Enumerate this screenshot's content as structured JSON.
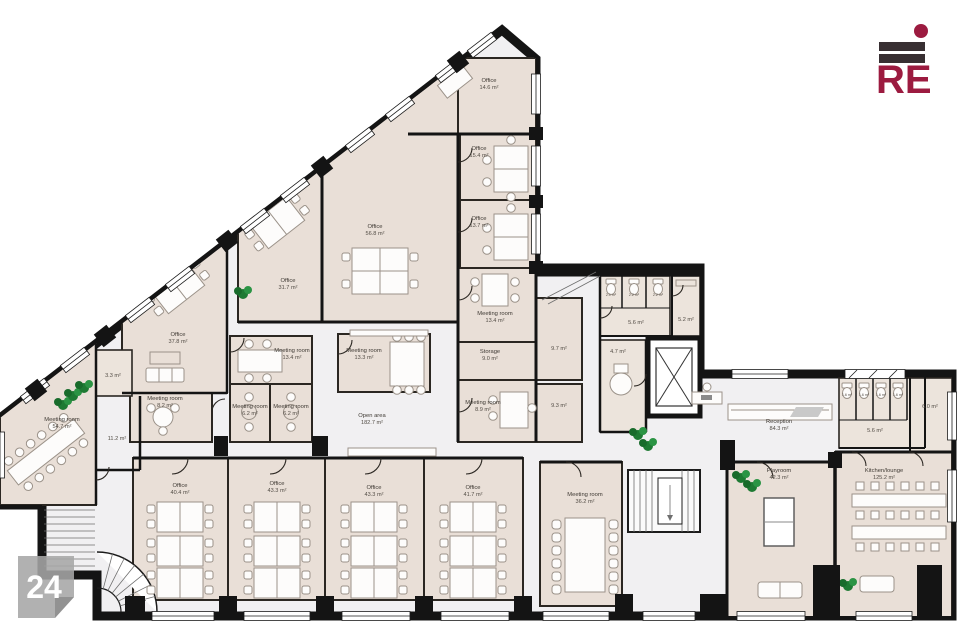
{
  "page_number": "24",
  "logo": {
    "text": "RE",
    "accent_color": "#9c1b40",
    "bar_color": "#382f32"
  },
  "floor_plan": {
    "rooms": [
      {
        "name": "Office",
        "area": "14.6 m²"
      },
      {
        "name": "Office",
        "area": "15.4 m²"
      },
      {
        "name": "Office",
        "area": "13.7 m²"
      },
      {
        "name": "Meeting room",
        "area": "13.4 m²"
      },
      {
        "name": "Storage",
        "area": "9.0 m²"
      },
      {
        "name": "Meeting room",
        "area": "8.9 m²"
      },
      {
        "name": "Office",
        "area": "56.8 m²"
      },
      {
        "name": "Office",
        "area": "31.7 m²"
      },
      {
        "name": "Office",
        "area": "37.8 m²"
      },
      {
        "name": "Meeting room",
        "area": "8.2 m²"
      },
      {
        "name": "Meeting room",
        "area": "13.4 m²"
      },
      {
        "name": "Meeting room",
        "area": "6.2 m²"
      },
      {
        "name": "Meeting room",
        "area": "6.2 m²"
      },
      {
        "name": "Meeting room",
        "area": "13.3 m²"
      },
      {
        "name": "Open area",
        "area": "182.7 m²"
      },
      {
        "name": "Meeting room",
        "area": "54.7 m²"
      },
      {
        "area": "3.3 m²"
      },
      {
        "area": "11.2 m²"
      },
      {
        "area": "9.7 m²"
      },
      {
        "area": "9.3 m²"
      },
      {
        "area": "2.1 m²"
      },
      {
        "area": "2.2 m²"
      },
      {
        "area": "2.2 m²"
      },
      {
        "area": "5.6 m²"
      },
      {
        "area": "5.2 m²"
      },
      {
        "area": "4.7 m²"
      },
      {
        "name": "Reception",
        "area": "84.3 m²"
      },
      {
        "area": "1.6 m²"
      },
      {
        "area": "1.6 m²"
      },
      {
        "area": "1.6 m²"
      },
      {
        "area": "1.6 m²"
      },
      {
        "area": "5.6 m²"
      },
      {
        "area": "6.0 m²"
      },
      {
        "name": "Office",
        "area": "40.4 m²"
      },
      {
        "name": "Office",
        "area": "43.3 m²"
      },
      {
        "name": "Office",
        "area": "43.3 m²"
      },
      {
        "name": "Office",
        "area": "41.7 m²"
      },
      {
        "name": "Meeting room",
        "area": "36.2 m²"
      },
      {
        "name": "Playroom",
        "area": "42.3 m²"
      },
      {
        "name": "Kitchen/lounge",
        "area": "125.2 m²"
      }
    ]
  }
}
